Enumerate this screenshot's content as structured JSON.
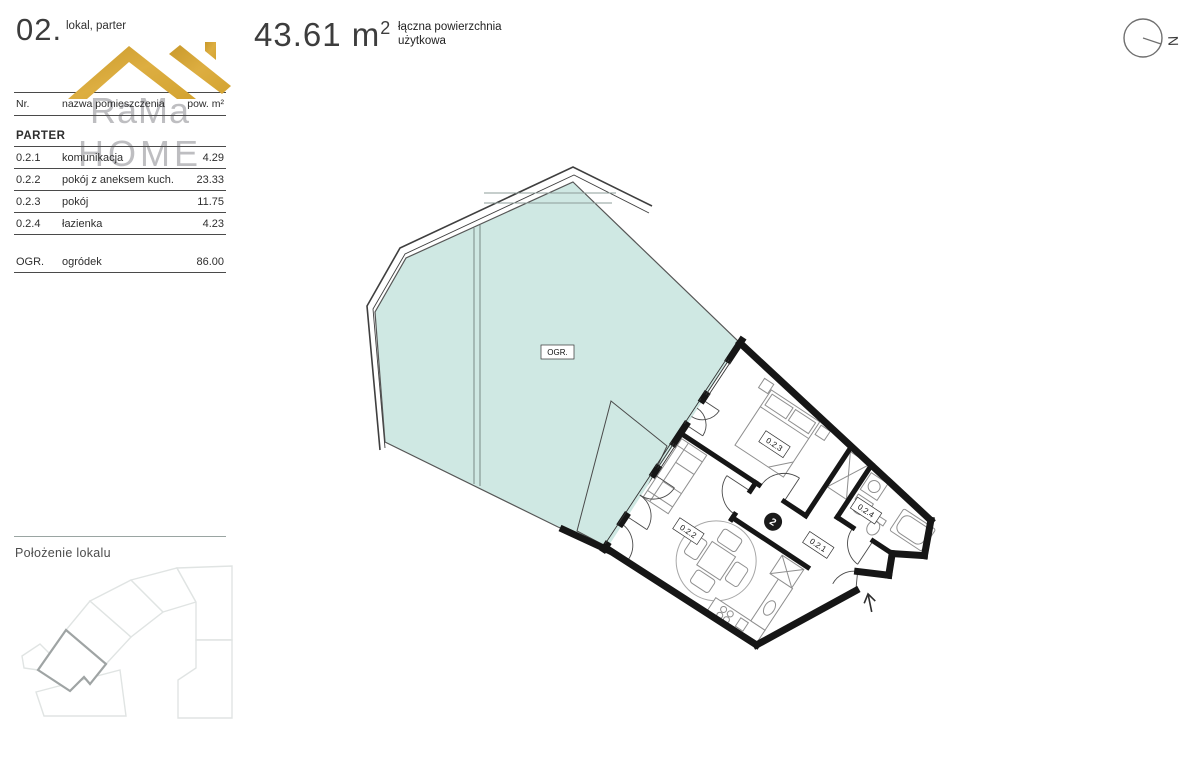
{
  "header": {
    "unit_number": "02.",
    "unit_type": "lokal, parter",
    "area_value": "43.61 m",
    "area_sup": "2",
    "area_caption_line1": "łączna powierzchnia",
    "area_caption_line2": "użytkowa"
  },
  "logo": {
    "line1": "RaMa",
    "line2": "HOME"
  },
  "table": {
    "columns": {
      "nr": "Nr.",
      "name": "nazwa pomieszczenia",
      "area": "pow. m²"
    },
    "section": "PARTER",
    "rows": [
      {
        "nr": "0.2.1",
        "name": "komunikacja",
        "area": "4.29"
      },
      {
        "nr": "0.2.2",
        "name": "pokój z aneksem kuch.",
        "area": "23.33"
      },
      {
        "nr": "0.2.3",
        "name": "pokój",
        "area": "11.75"
      },
      {
        "nr": "0.2.4",
        "name": "łazienka",
        "area": "4.23"
      }
    ],
    "garden_row": {
      "nr": "OGR.",
      "name": "ogródek",
      "area": "86.00"
    }
  },
  "location": {
    "title": "Położenie lokalu"
  },
  "plan": {
    "garden_label": "OGR.",
    "labels": {
      "living": "0.2.2",
      "bedroom": "0.2.3",
      "bathroom": "0.2.4",
      "hall": "0.2.1"
    },
    "unit_badge": "2"
  },
  "compass": {
    "north": "N"
  },
  "colors": {
    "garden_fill": "#cfe8e3",
    "wall": "#161616",
    "logo_gold": "#d8a93a",
    "logo_gray": "#97979c",
    "furniture_line": "#8f8f8f"
  }
}
